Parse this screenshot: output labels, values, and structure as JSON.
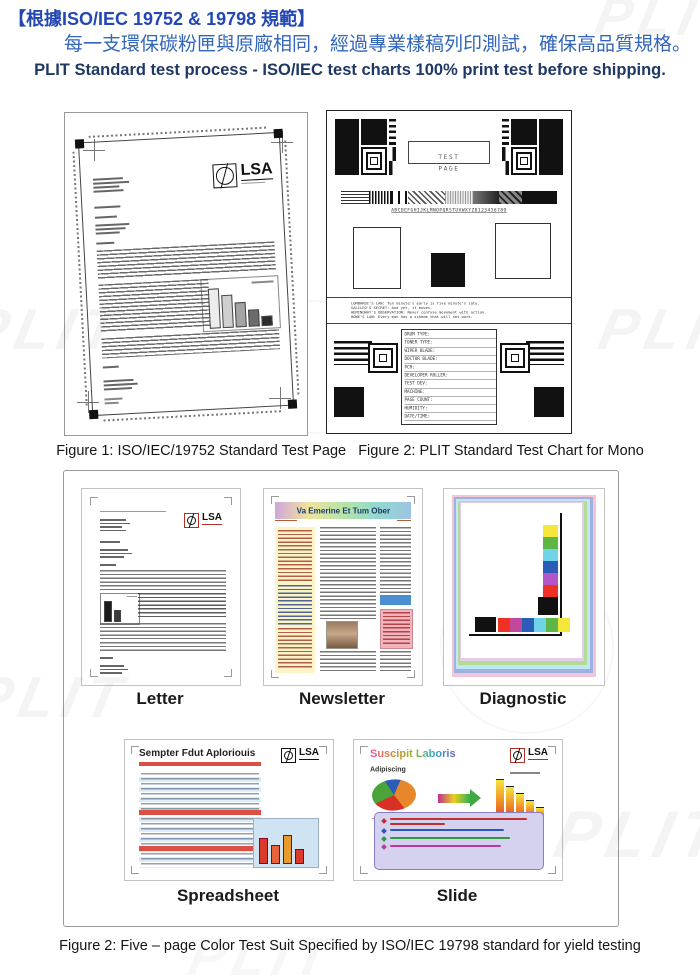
{
  "header": {
    "line1_zh": "【根據ISO/IEC 19752 & 19798 規範】",
    "line2_zh": "每一支環保碳粉匣與原廠相同，經過專業樣稿列印測試，確保高品質規格。",
    "line3_en": "PLIT Standard test process - ISO/IEC test charts 100% print test before shipping."
  },
  "captions": {
    "figures_row": "Figure 1: ISO/IEC/19752 Standard Test Page   Figure 2: PLIT Standard Test Chart for Mono",
    "suite": "Figure 2: Five – page Color Test Suit Specified by ISO/IEC 19798 standard for yield testing"
  },
  "watermark": "PLIT",
  "figure1": {
    "logo": "LSA"
  },
  "mono": {
    "test_page_label": "TEST PAGE",
    "alphabet_line": "ABCDEFGHIJKLMNOPQRSTUVWXYZ0123456789",
    "quotes": [
      "LOMBARDI'S LAW:  Ten minute's early is five minute's late.",
      "GALILEO'S SECRET:  And yet, it moves.",
      "HEMINGWAY'S OBSERVATION:  Never confuse movement with action.",
      "HOWE'S LAW:  Every man has a scheme that will not work."
    ],
    "form_fields": [
      "DRUM TYPE:",
      "TONER TYPE:",
      "WIPER BLADE:",
      "DOCTOR BLADE:",
      "PCR:",
      "DEVELOPER ROLLER:",
      "TEST DEV:",
      "MACHINE:",
      "PAGE COUNT:",
      "HUMIDITY:",
      "DATE/TIME:"
    ]
  },
  "suite": {
    "items": [
      {
        "label": "Letter",
        "logo": "LSA"
      },
      {
        "label": "Newsletter",
        "title": "Va Emerine Et Tum Ober"
      },
      {
        "label": "Diagnostic"
      },
      {
        "label": "Spreadsheet",
        "title": "Sempter Fdut Aploriouis",
        "logo": "LSA"
      },
      {
        "label": "Slide",
        "title": "Suscipit Laboris",
        "pie_label": "Adipiscing",
        "logo": "LSA"
      }
    ]
  },
  "colors": {
    "heading_blue": "#2348b5",
    "subheading_blue": "#3166bb",
    "navy": "#1f3864",
    "lsa_red": "#c0392b",
    "swatch_red": "#ee3124",
    "swatch_green": "#5db645",
    "swatch_blue": "#2a5cb8",
    "swatch_cyan": "#6fd4e8",
    "swatch_yellow": "#f5e63c",
    "swatch_magenta": "#c2489e",
    "swatch_black": "#111111"
  }
}
